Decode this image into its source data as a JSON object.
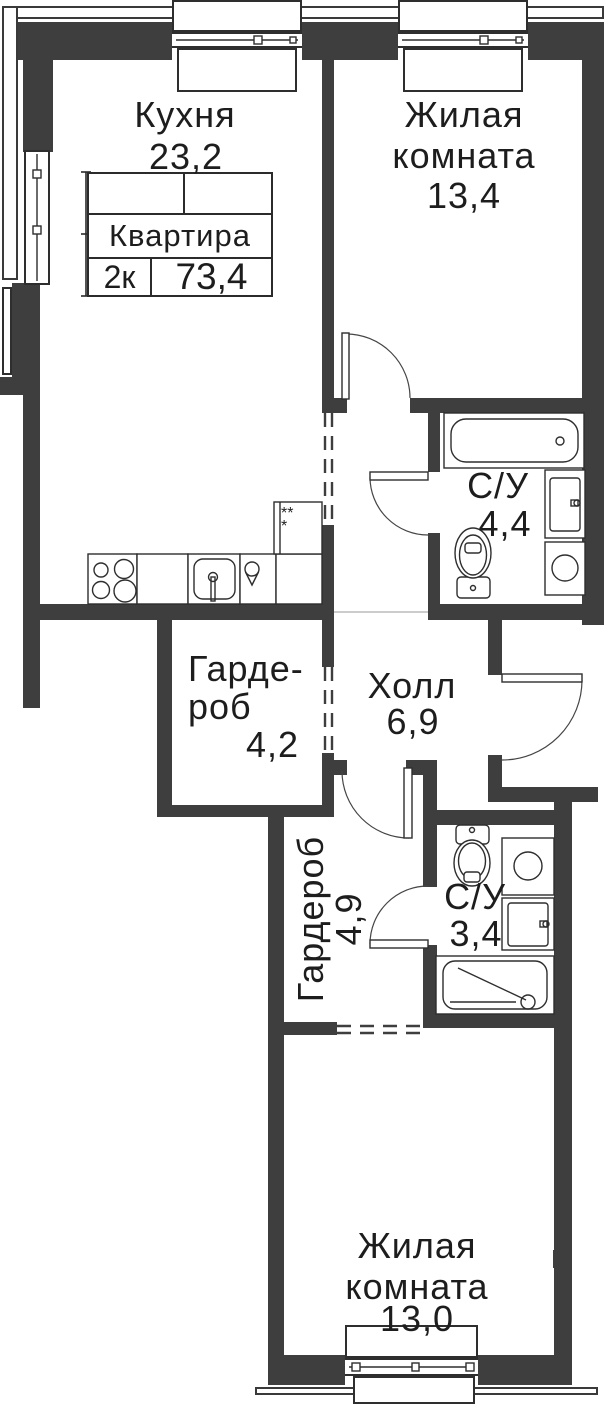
{
  "title_block": {
    "name": "Квартира",
    "type": "2к",
    "area": "73,4"
  },
  "rooms": {
    "kitchen": {
      "name": "Кухня",
      "area": "23,2"
    },
    "living1": {
      "line1": "Жилая",
      "line2": "комната",
      "area": "13,4"
    },
    "bath1": {
      "name": "С/У",
      "area": "4,4"
    },
    "wardrobe1": {
      "line1": "Гарде-",
      "line2": "роб",
      "area": "4,2"
    },
    "hall": {
      "name": "Холл",
      "area": "6,9"
    },
    "wardrobe2": {
      "name": "Гардероб",
      "area": "4,9"
    },
    "bath2": {
      "name": "С/У",
      "area": "3,4"
    },
    "living2": {
      "line1": "Жилая",
      "line2": "комната",
      "area": "13,0"
    }
  },
  "symbols": {
    "shaft": "***"
  },
  "colors": {
    "wall": "#3e3e3e",
    "line": "#2e2e2e"
  }
}
